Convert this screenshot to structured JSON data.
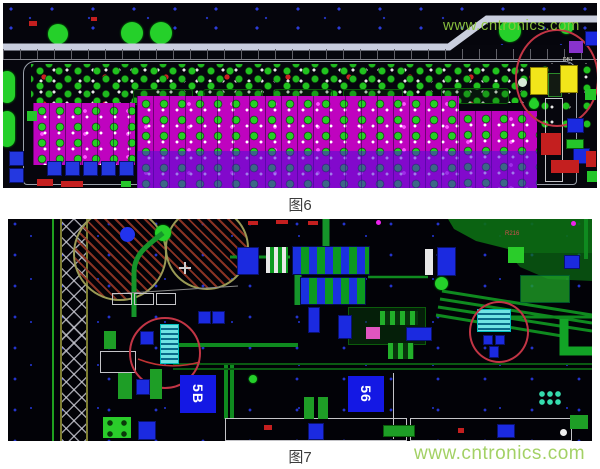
{
  "page": {
    "background": "#ffffff"
  },
  "figure6": {
    "caption": "图6",
    "annotation_color": "#c23545",
    "highlight_component_color": "#f2e51a",
    "component_label": "DB1"
  },
  "figure7": {
    "caption": "图7",
    "annotation_color": "#c23545",
    "chip_label_left": "5B",
    "chip_label_right": "56",
    "ref_label": "R216"
  },
  "watermark": {
    "text": "www.cntronics.com",
    "color": "#8dc63f"
  }
}
